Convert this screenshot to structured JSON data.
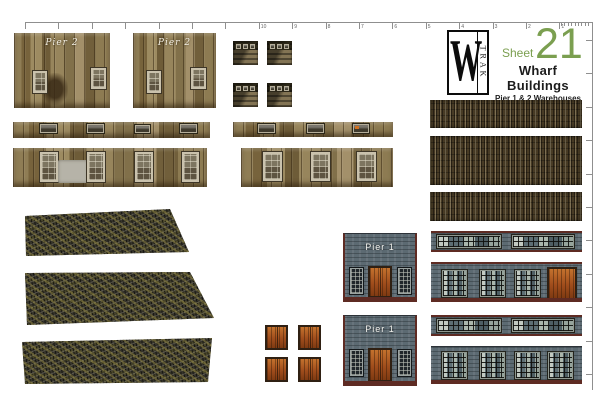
{
  "ruler": {
    "h_labels": [
      "",
      "",
      "",
      "",
      "",
      "",
      "",
      "10",
      "9",
      "8",
      "7",
      "6",
      "5",
      "4",
      "3",
      "2",
      "1"
    ],
    "fine_tick_count": 9,
    "v_tick_count": 11
  },
  "header": {
    "logo_w": "W",
    "logo_trak": "TRAK",
    "sheet_word": "Sheet",
    "sheet_number": "21",
    "title": "Wharf Buildings",
    "subtitle": "Pier 1 & 2 Warehouses",
    "note": "(optimized for Bay & Bridge)"
  },
  "labels": {
    "pier1": "Pier 1",
    "pier2": "Pier 2"
  },
  "colors": {
    "accent_green": "#7b9f50",
    "wood_wall": "#8d7a50",
    "tar_roof": "#35332a",
    "dark_plank": "#483b25",
    "brick_gray": "#5c6a72",
    "trim_maroon": "#5e2b23",
    "door_orange": "#b05a20"
  }
}
